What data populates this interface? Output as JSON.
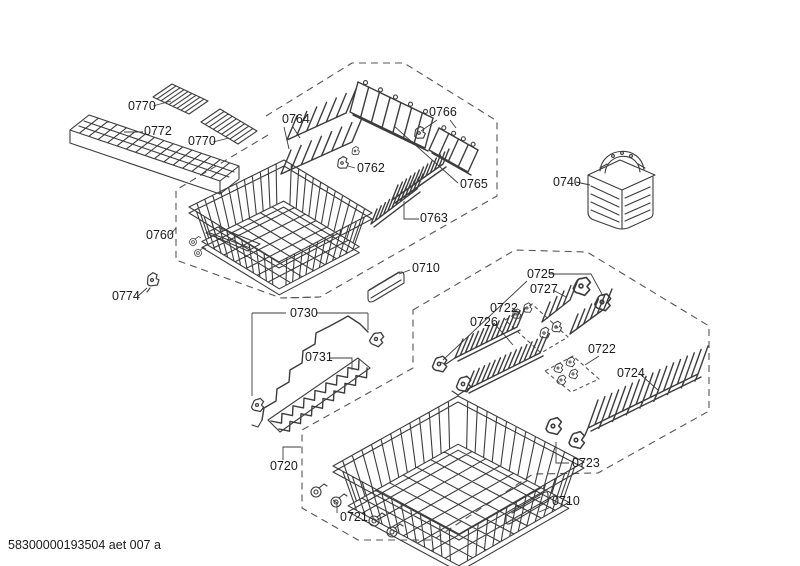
{
  "document": {
    "footer_code": "58300000193504 aet 007 a"
  },
  "colors": {
    "background": "#ffffff",
    "line": "#3c3c3c",
    "dash": "#555555",
    "label_text": "#1a1a1a"
  },
  "labels": [
    "0770",
    "0772",
    "0770",
    "0760",
    "0774",
    "0764",
    "0762",
    "0766",
    "0765",
    "0763",
    "0740",
    "0710",
    "0730",
    "0731",
    "0725",
    "0727",
    "0722",
    "0726",
    "0722",
    "0724",
    "0723",
    "0720",
    "0721",
    "0710"
  ]
}
